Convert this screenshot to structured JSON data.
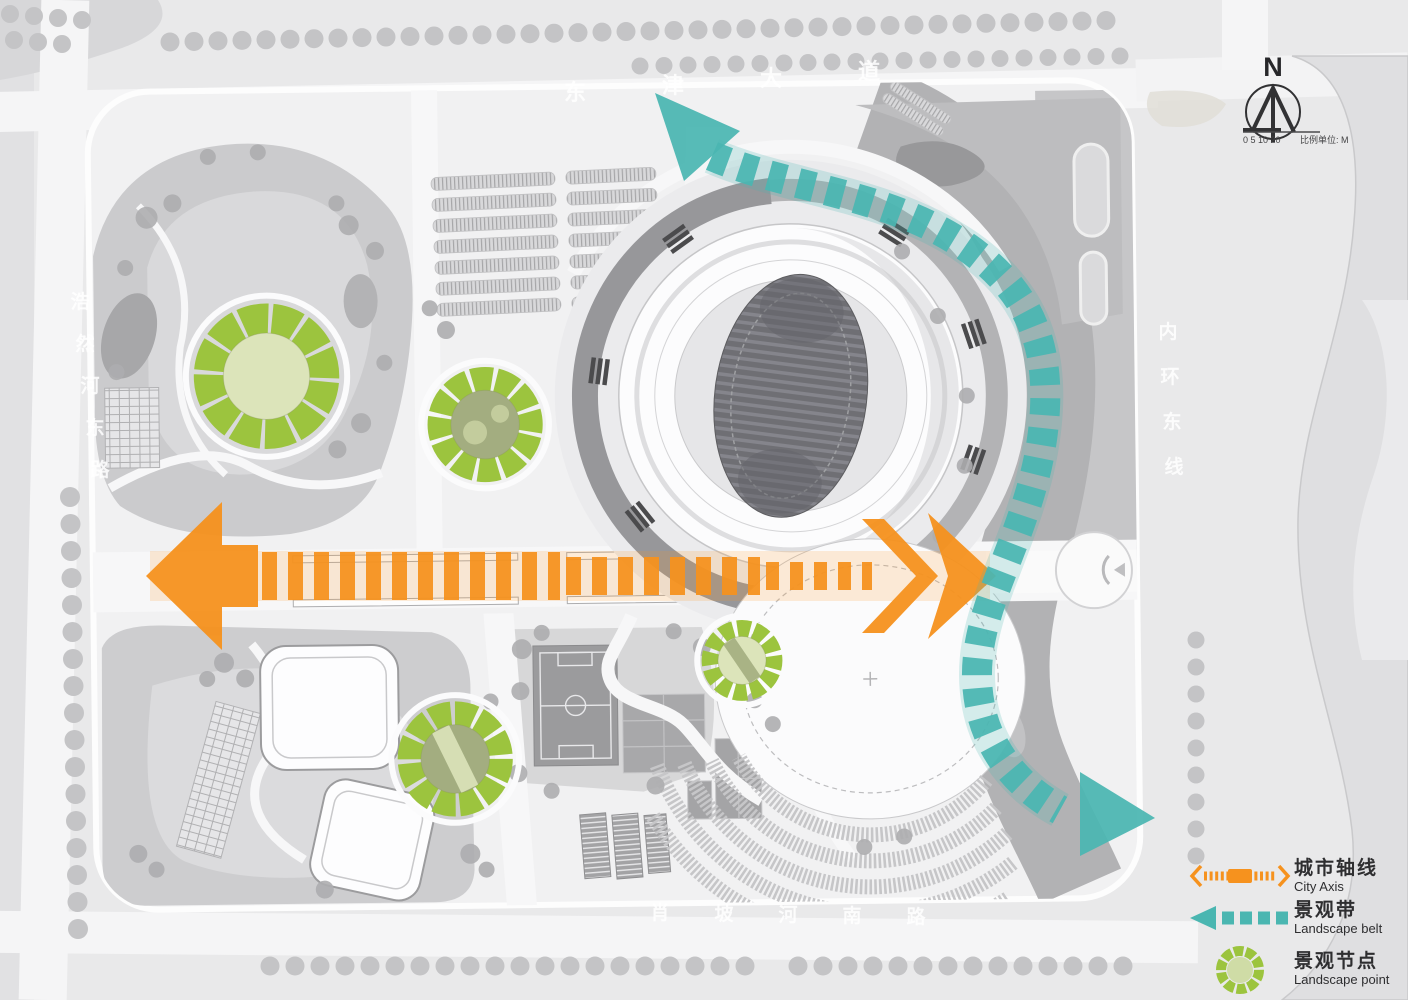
{
  "compass": {
    "n": "N"
  },
  "scale_bar": {
    "ticks": "0 5 10   20",
    "unit": "比例单位: M"
  },
  "road_labels": [
    {
      "id": "dongjin-avenue",
      "text": "东津大道"
    },
    {
      "id": "haoranhe-east-road",
      "text": "浩然河东路"
    },
    {
      "id": "inner-ring-east-line",
      "text": "内环东线"
    },
    {
      "id": "xiaopohe-south-road",
      "text": "肖坡河南路"
    }
  ],
  "legend": {
    "items": [
      {
        "id": "city-axis",
        "label_cn": "城市轴线",
        "label_en": "City Axis",
        "color": "#F6921E",
        "symbol": "axis-with-double-arrow"
      },
      {
        "id": "landscape-belt",
        "label_cn": "景观带",
        "label_en": "Landscape belt",
        "color": "#4AB6B1",
        "symbol": "dashed-arrow"
      },
      {
        "id": "landscape-point",
        "label_cn": "景观节点",
        "label_en": "Landscape point",
        "color": "#9CC43E",
        "symbol": "gear-circle"
      }
    ]
  },
  "annotations": {
    "city_axis": {
      "color": "#F6921E",
      "direction": "horizontal",
      "arrows": "both-ends"
    },
    "landscape_belt": {
      "color": "#4AB6B1",
      "style": "dashed-curve",
      "arrows": "both-ends"
    },
    "landscape_points": {
      "count": 4,
      "color": "#9CC43E",
      "center_pale": "#dce4ba",
      "center_olive": "#a3ad80"
    }
  },
  "colors": {
    "page_bg": "#e9e9ea",
    "site_bg": "#f1f1f2",
    "road": "#f7f7f8",
    "park": "#cdcdcf",
    "river": "#b2b2b4",
    "field": "#74747a",
    "tree": "#b4b4b6"
  }
}
